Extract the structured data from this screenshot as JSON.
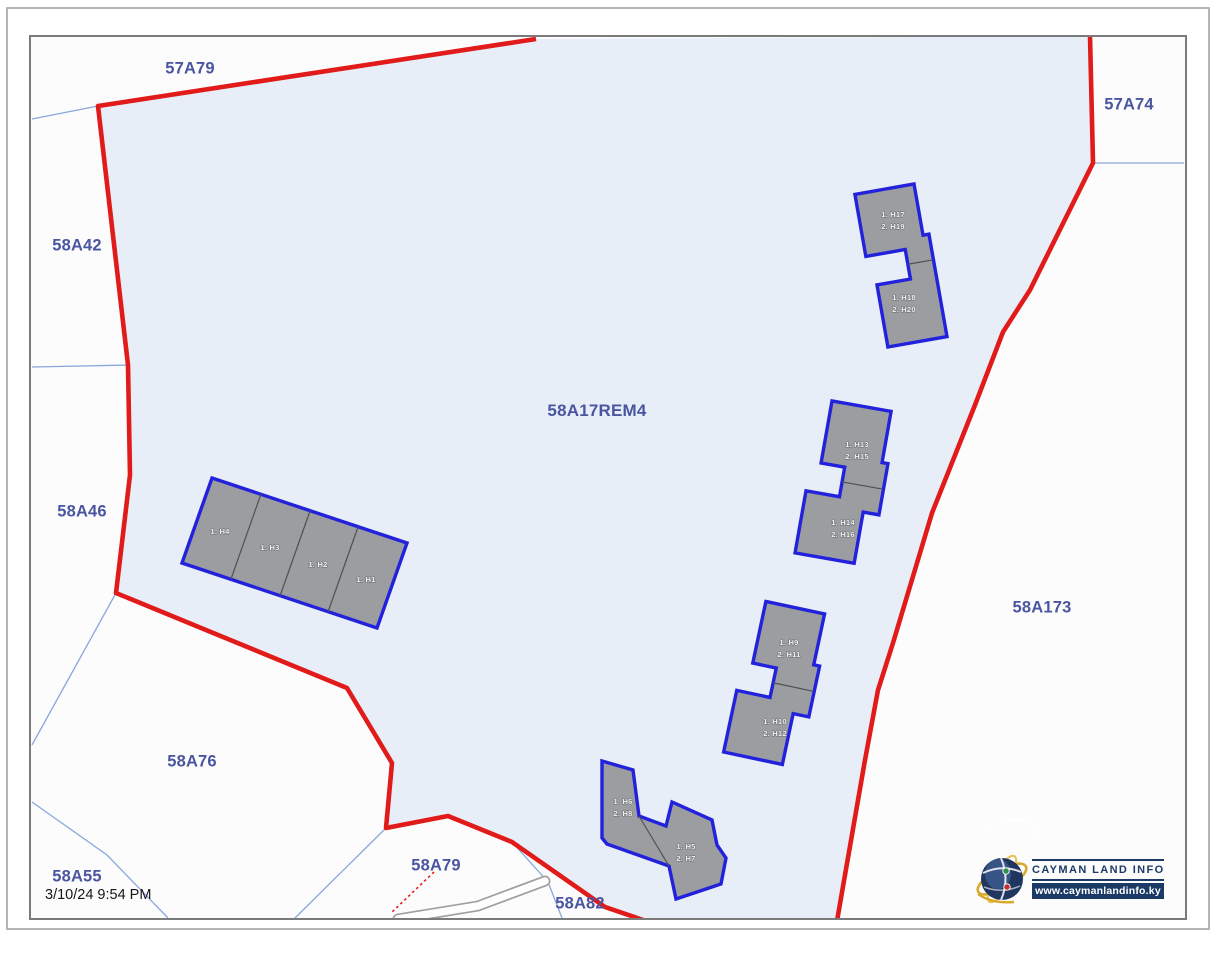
{
  "page": {
    "date_label": "3/10/24 9:54 PM"
  },
  "logo": {
    "title": "CAYMAN LAND INFO",
    "url": "www.caymanlandinfo.ky"
  },
  "parcels": [
    {
      "id": "57A79",
      "label": "57A79",
      "x": 190,
      "y": 69
    },
    {
      "id": "57A74",
      "label": "57A74",
      "x": 1129,
      "y": 105
    },
    {
      "id": "58A42",
      "label": "58A42",
      "x": 77,
      "y": 246
    },
    {
      "id": "58A46",
      "label": "58A46",
      "x": 82,
      "y": 512
    },
    {
      "id": "58A17REM4",
      "label": "58A17REM4",
      "x": 597,
      "y": 411
    },
    {
      "id": "58A173",
      "label": "58A173",
      "x": 1042,
      "y": 608
    },
    {
      "id": "58A76",
      "label": "58A76",
      "x": 192,
      "y": 762
    },
    {
      "id": "58A55",
      "label": "58A55",
      "x": 77,
      "y": 877
    },
    {
      "id": "58A79",
      "label": "58A79",
      "x": 436,
      "y": 866
    },
    {
      "id": "58A82",
      "label": "58A82",
      "x": 580,
      "y": 904
    }
  ],
  "map": {
    "colors": {
      "map_bg": "#fcfcfc",
      "parcel_fill": "#e8eef7",
      "red_boundary": "#e11a1a",
      "blue_line": "#8aa7dc",
      "building_fill": "#9b9da0",
      "building_stroke": "#2222dd",
      "divider": "#4e5054",
      "road_casing": "#a0a0a0",
      "outer_frame": "#b5b5b5",
      "map_frame": "#7a7a7a"
    },
    "parcel_polygon": [
      [
        98,
        106
      ],
      [
        536,
        39
      ],
      [
        1090,
        36
      ],
      [
        1093,
        163
      ],
      [
        1030,
        290
      ],
      [
        1003,
        332
      ],
      [
        975,
        405
      ],
      [
        932,
        513
      ],
      [
        893,
        643
      ],
      [
        878,
        690
      ],
      [
        865,
        760
      ],
      [
        837,
        919
      ],
      [
        646,
        919
      ],
      [
        605,
        907
      ],
      [
        512,
        842
      ],
      [
        448,
        816
      ],
      [
        386,
        828
      ],
      [
        392,
        763
      ],
      [
        347,
        688
      ],
      [
        116,
        593
      ],
      [
        130,
        475
      ],
      [
        128,
        365
      ],
      [
        117,
        270
      ]
    ],
    "red_boundaries": [
      [
        [
          536,
          39
        ],
        [
          98,
          106
        ],
        [
          117,
          270
        ],
        [
          128,
          365
        ],
        [
          130,
          475
        ],
        [
          116,
          593
        ],
        [
          347,
          688
        ],
        [
          392,
          763
        ],
        [
          386,
          828
        ],
        [
          448,
          816
        ],
        [
          512,
          842
        ],
        [
          605,
          907
        ],
        [
          646,
          921
        ]
      ],
      [
        [
          1090,
          36
        ],
        [
          1093,
          163
        ],
        [
          1030,
          290
        ],
        [
          1003,
          332
        ],
        [
          975,
          405
        ],
        [
          932,
          513
        ],
        [
          893,
          643
        ],
        [
          878,
          690
        ],
        [
          865,
          760
        ],
        [
          837,
          921
        ]
      ]
    ],
    "red_dotted": [
      [
        434,
        872
      ],
      [
        391,
        913
      ]
    ],
    "blue_lines": [
      [
        [
          32,
          119
        ],
        [
          98,
          106
        ]
      ],
      [
        [
          32,
          367
        ],
        [
          130,
          365
        ]
      ],
      [
        [
          116,
          593
        ],
        [
          32,
          745
        ]
      ],
      [
        [
          32,
          802
        ],
        [
          107,
          855
        ],
        [
          168,
          918
        ]
      ],
      [
        [
          386,
          828
        ],
        [
          295,
          918
        ]
      ],
      [
        [
          512,
          842
        ],
        [
          548,
          882
        ],
        [
          562,
          918
        ]
      ],
      [
        [
          1093,
          163
        ],
        [
          1184,
          163
        ]
      ]
    ],
    "road": [
      [
        545,
        881
      ],
      [
        478,
        906
      ],
      [
        398,
        919
      ]
    ],
    "duplexes": [
      {
        "name": "building-h17-h20",
        "cx": 898,
        "cy": 266,
        "rot": -10,
        "dx": 6,
        "units": [
          {
            "lines": [
              "1. H17",
              "2. H19"
            ],
            "lx": 893,
            "ly": 220
          },
          {
            "lines": [
              "1. H18",
              "2. H20"
            ],
            "lx": 904,
            "ly": 303
          }
        ]
      },
      {
        "name": "building-h13-h16",
        "cx": 848,
        "cy": 483,
        "rot": 10,
        "dx": -10,
        "units": [
          {
            "lines": [
              "1. H13",
              "2. H15"
            ],
            "lx": 857,
            "ly": 450
          },
          {
            "lines": [
              "1. H14",
              "2. H16"
            ],
            "lx": 843,
            "ly": 528
          }
        ]
      },
      {
        "name": "building-h9-h12",
        "cx": 779,
        "cy": 684,
        "rot": 12,
        "dx": -10,
        "units": [
          {
            "lines": [
              "1. H9",
              "2. H11"
            ],
            "lx": 789,
            "ly": 648
          },
          {
            "lines": [
              "1. H10",
              "2. H12"
            ],
            "lx": 775,
            "ly": 727
          }
        ]
      }
    ],
    "polygons": [
      {
        "name": "building-h5-h8",
        "outline": [
          [
            602,
            761
          ],
          [
            633,
            770
          ],
          [
            639,
            816
          ],
          [
            666,
            826
          ],
          [
            672,
            802
          ],
          [
            712,
            820
          ],
          [
            717,
            845
          ],
          [
            726,
            858
          ],
          [
            721,
            884
          ],
          [
            676,
            899
          ],
          [
            669,
            866
          ],
          [
            607,
            844
          ],
          [
            602,
            838
          ]
        ],
        "dividers": [
          [
            [
              639,
              816
            ],
            [
              669,
              866
            ]
          ]
        ],
        "labels": [
          {
            "lines": [
              "1. H6",
              "2. H8"
            ],
            "lx": 623,
            "ly": 807
          },
          {
            "lines": [
              "1. H5",
              "2. H7"
            ],
            "lx": 686,
            "ly": 852
          }
        ]
      },
      {
        "name": "building-h1-h4",
        "outline": [
          [
            212,
            478
          ],
          [
            407,
            543
          ],
          [
            377,
            628
          ],
          [
            182,
            563
          ]
        ],
        "dividers": [
          [
            [
              261,
              494
            ],
            [
              231,
              579
            ]
          ],
          [
            [
              310,
              511
            ],
            [
              280,
              596
            ]
          ],
          [
            [
              358,
              527
            ],
            [
              328,
              612
            ]
          ]
        ],
        "labels": [
          {
            "lines": [
              "1. H4"
            ],
            "lx": 220,
            "ly": 531
          },
          {
            "lines": [
              "1. H3"
            ],
            "lx": 270,
            "ly": 547
          },
          {
            "lines": [
              "1. H2"
            ],
            "lx": 318,
            "ly": 564
          },
          {
            "lines": [
              "1. H1"
            ],
            "lx": 366,
            "ly": 579
          }
        ]
      }
    ]
  }
}
